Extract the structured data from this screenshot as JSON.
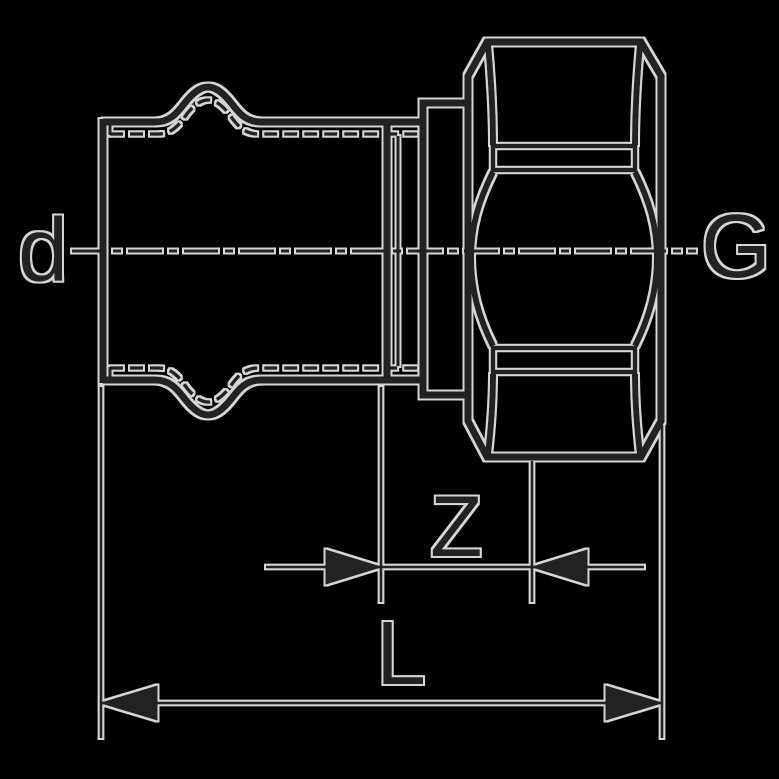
{
  "drawing": {
    "labels": {
      "press_end_diameter": "d",
      "thread_end": "G",
      "z_dimension": "Z",
      "overall_length": "L"
    },
    "colors": {
      "background": "#000000",
      "line": "#222222",
      "halo": "#d6d6d6"
    }
  }
}
